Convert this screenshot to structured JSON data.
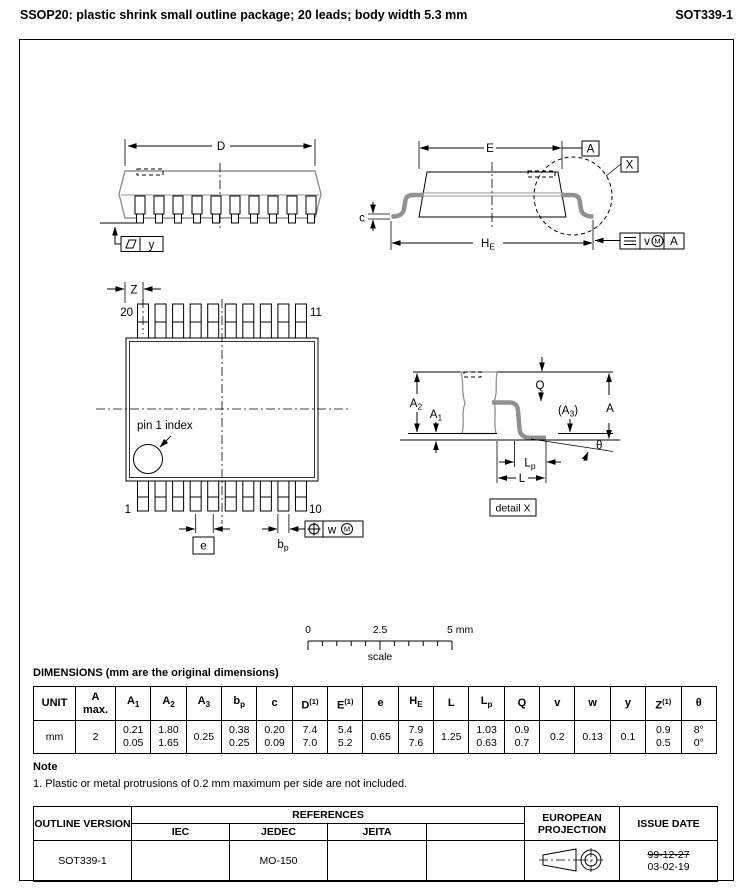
{
  "header": {
    "title": "SSOP20: plastic shrink small outline package; 20 leads; body width 5.3 mm",
    "doc_id": "SOT339-1"
  },
  "diagrams": {
    "perspective_view": {
      "dim_D": "D",
      "datum_y": "y"
    },
    "side_view": {
      "dim_E": "E",
      "datum_A": "A",
      "detail_ref": "X",
      "dim_c": "c",
      "dim_HE_base": "H",
      "dim_HE_sub": "E",
      "tol_v": "v",
      "tol_M": "M",
      "tol_datum": "A"
    },
    "top_view": {
      "dim_Z": "Z",
      "pin_20": "20",
      "pin_11": "11",
      "pin_1": "1",
      "pin_10": "10",
      "pin1_index": "pin 1 index",
      "dim_e": "e",
      "dim_bp_base": "b",
      "dim_bp_sub": "p",
      "tol_w": "w",
      "tol_M": "M"
    },
    "detail_x": {
      "dim_A2_base": "A",
      "dim_A2_sub": "2",
      "dim_A1_base": "A",
      "dim_A1_sub": "1",
      "dim_Q": "Q",
      "dim_A3_pre": "(A",
      "dim_A3_sub": "3",
      "dim_A3_post": ")",
      "dim_A": "A",
      "dim_Lp_base": "L",
      "dim_Lp_sub": "p",
      "dim_L": "L",
      "dim_theta": "θ",
      "caption": "detail X"
    },
    "scale_bar": {
      "tick_start": "0",
      "tick_mid": "2.5",
      "tick_end": "5 mm",
      "caption": "scale"
    }
  },
  "dimensions_table": {
    "title": "DIMENSIONS (mm are the original dimensions)",
    "columns": [
      {
        "t": "UNIT"
      },
      {
        "t": "A",
        "line2": "max."
      },
      {
        "t": "A",
        "sub": "1"
      },
      {
        "t": "A",
        "sub": "2"
      },
      {
        "t": "A",
        "sub": "3"
      },
      {
        "t": "b",
        "sub": "p"
      },
      {
        "t": "c"
      },
      {
        "t": "D",
        "sup": "(1)"
      },
      {
        "t": "E",
        "sup": "(1)"
      },
      {
        "t": "e"
      },
      {
        "t": "H",
        "sub": "E"
      },
      {
        "t": "L"
      },
      {
        "t": "L",
        "sub": "p"
      },
      {
        "t": "Q"
      },
      {
        "t": "v"
      },
      {
        "t": "w"
      },
      {
        "t": "y"
      },
      {
        "t": "Z",
        "sup": "(1)"
      },
      {
        "t": "θ"
      }
    ],
    "rows": [
      [
        [
          "mm"
        ],
        [
          "2"
        ],
        [
          "0.21",
          "0.05"
        ],
        [
          "1.80",
          "1.65"
        ],
        [
          "0.25"
        ],
        [
          "0.38",
          "0.25"
        ],
        [
          "0.20",
          "0.09"
        ],
        [
          "7.4",
          "7.0"
        ],
        [
          "5.4",
          "5.2"
        ],
        [
          "0.65"
        ],
        [
          "7.9",
          "7.6"
        ],
        [
          "1.25"
        ],
        [
          "1.03",
          "0.63"
        ],
        [
          "0.9",
          "0.7"
        ],
        [
          "0.2"
        ],
        [
          "0.13"
        ],
        [
          "0.1"
        ],
        [
          "0.9",
          "0.5"
        ],
        [
          "8°",
          "0°"
        ]
      ]
    ]
  },
  "note": {
    "heading": "Note",
    "items": [
      "1. Plastic or metal protrusions of 0.2 mm maximum per side are not included."
    ]
  },
  "footer_table": {
    "outline_version_label": "OUTLINE VERSION",
    "references_label": "REFERENCES",
    "ref_columns": [
      "IEC",
      "JEDEC",
      "JEITA",
      ""
    ],
    "projection_label": "EUROPEAN PROJECTION",
    "issue_date_label": "ISSUE DATE",
    "row": {
      "outline_version": "SOT339-1",
      "iec": "",
      "jedec": "MO-150",
      "jeita": "",
      "extra": "",
      "issue_date_old": "99-12-27",
      "issue_date_new": "03-02-19"
    }
  }
}
